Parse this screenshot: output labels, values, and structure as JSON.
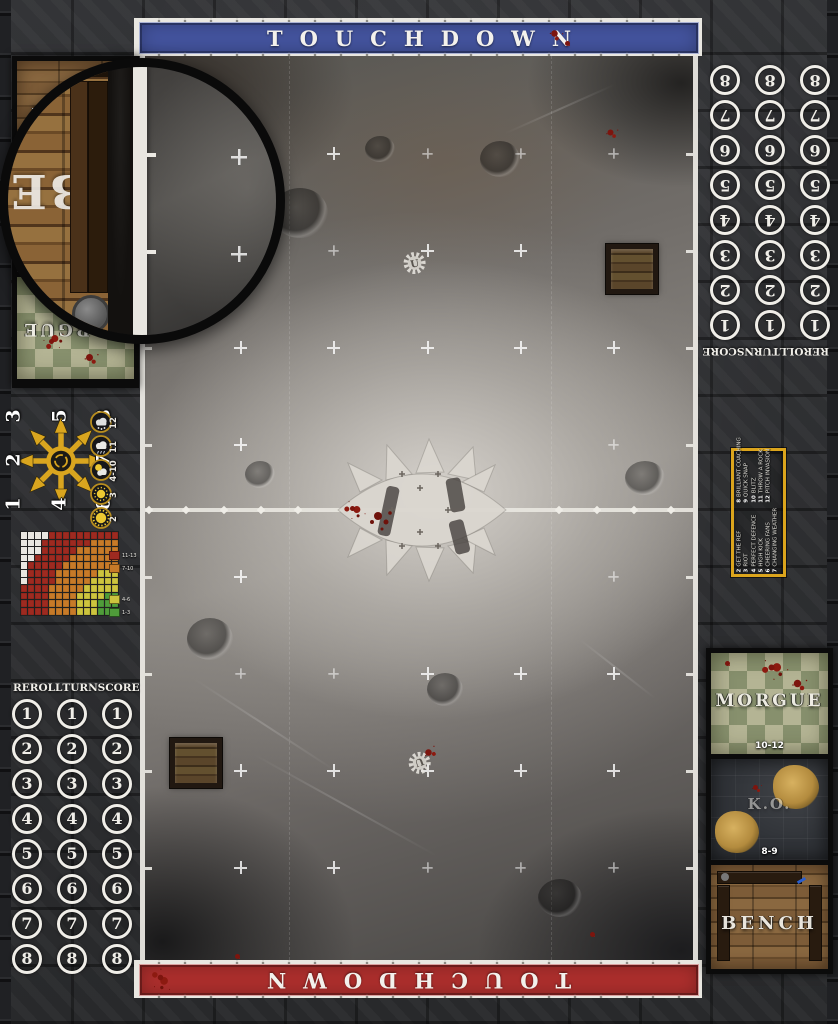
{
  "banners": {
    "top": {
      "label": "TOUCHDOWN",
      "color": "#44549f"
    },
    "bottom": {
      "label": "TOUCHDOWN",
      "color": "#ae2f2d"
    }
  },
  "turn_track": {
    "headers": [
      "REROLL",
      "TURN",
      "SCORE"
    ],
    "numbers": [
      "1",
      "2",
      "3",
      "4",
      "5",
      "6",
      "7",
      "8"
    ],
    "columns": 3
  },
  "dugout": {
    "morgue": {
      "label": "MORGUE",
      "range": "10-12"
    },
    "ko": {
      "label": "K.O.",
      "range": "8-9"
    },
    "bench": {
      "label": "BENCH"
    }
  },
  "magnifier": {
    "visible_text": "BE"
  },
  "scatter_template": {
    "numbers": [
      "1",
      "2",
      "3",
      "4",
      "5",
      "6",
      "7",
      "8"
    ],
    "star_color": "#d9a51f"
  },
  "weather_table": [
    {
      "roll": "12",
      "icon": "blizzard-icon"
    },
    {
      "roll": "11",
      "icon": "rain-cloud-icon"
    },
    {
      "roll": "4-10",
      "icon": "partly-cloudy-icon"
    },
    {
      "roll": "3",
      "icon": "sunny-icon"
    },
    {
      "roll": "2",
      "icon": "sweltering-sun-icon"
    }
  ],
  "kickoff_table": {
    "border_color": "#dba41c",
    "entries": [
      {
        "roll": "2",
        "event": "GET THE REF"
      },
      {
        "roll": "3",
        "event": "RIOT"
      },
      {
        "roll": "4",
        "event": "PERFECT DEFENCE"
      },
      {
        "roll": "5",
        "event": "HIGH KICK"
      },
      {
        "roll": "6",
        "event": "CHEERING FANS"
      },
      {
        "roll": "7",
        "event": "CHANGING WEATHER"
      },
      {
        "roll": "8",
        "event": "BRILLIANT COACHING"
      },
      {
        "roll": "9",
        "event": "QUICK SNAP"
      },
      {
        "roll": "10",
        "event": "BLITZ"
      },
      {
        "roll": "11",
        "event": "THROW A ROCK"
      },
      {
        "roll": "12",
        "event": "PITCH INVASION"
      }
    ]
  },
  "range_chart": {
    "rows": [
      "WWWWRRRRRRRRRR",
      "WWWRRRRRRROOOO",
      "WWWRRRRROOOOOO",
      "WWRRRRROOOOOOO",
      "WRRRRROOOOOOOO",
      "WRRRROOOOOOYYY",
      "WRRRROOOOOYYYY",
      "RRRROOOOOYYYYY",
      "RRRROOOOYYYYGG",
      "RRRROOOOYYYGGG",
      "RRRROOOOYYYGGG"
    ],
    "palette": {
      "W": "#e9e6e0",
      "R": "#9e2a20",
      "O": "#c77a28",
      "Y": "#cdc43e",
      "G": "#4f9c3a"
    },
    "legend": [
      {
        "code": "R",
        "label": "11-13"
      },
      {
        "code": "O",
        "label": "7-10"
      },
      {
        "code": "Y",
        "label": "4-6"
      },
      {
        "code": "G",
        "label": "1-3"
      }
    ]
  }
}
